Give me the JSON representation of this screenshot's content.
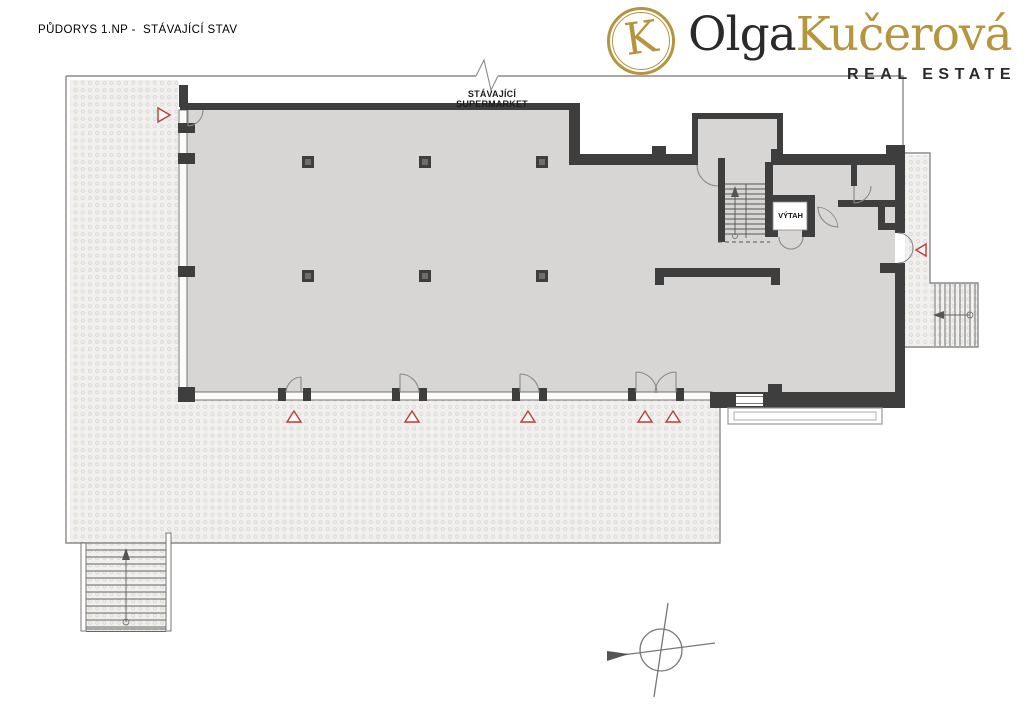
{
  "header": {
    "title": "PŮDORYS 1.NP -  STÁVAJÍCÍ STAV"
  },
  "logo": {
    "monogram": "K",
    "name_primary": "Olga",
    "name_secondary": "Kučerová",
    "tagline": "REAL ESTATE"
  },
  "plan": {
    "area_label": "STÁVAJÍCÍ SUPERMARKET",
    "elevator_label": "VÝTAH",
    "colors": {
      "wall": "#3e3e3e",
      "room_fill": "#d7d6d4",
      "hatch_base": "#f1f0ee",
      "hatch_dot": "#d8d7d4",
      "marker_red": "#b5403c",
      "line": "#8a8a8a",
      "logo_gold": "#b6953f",
      "logo_dark": "#2b2a28"
    }
  }
}
